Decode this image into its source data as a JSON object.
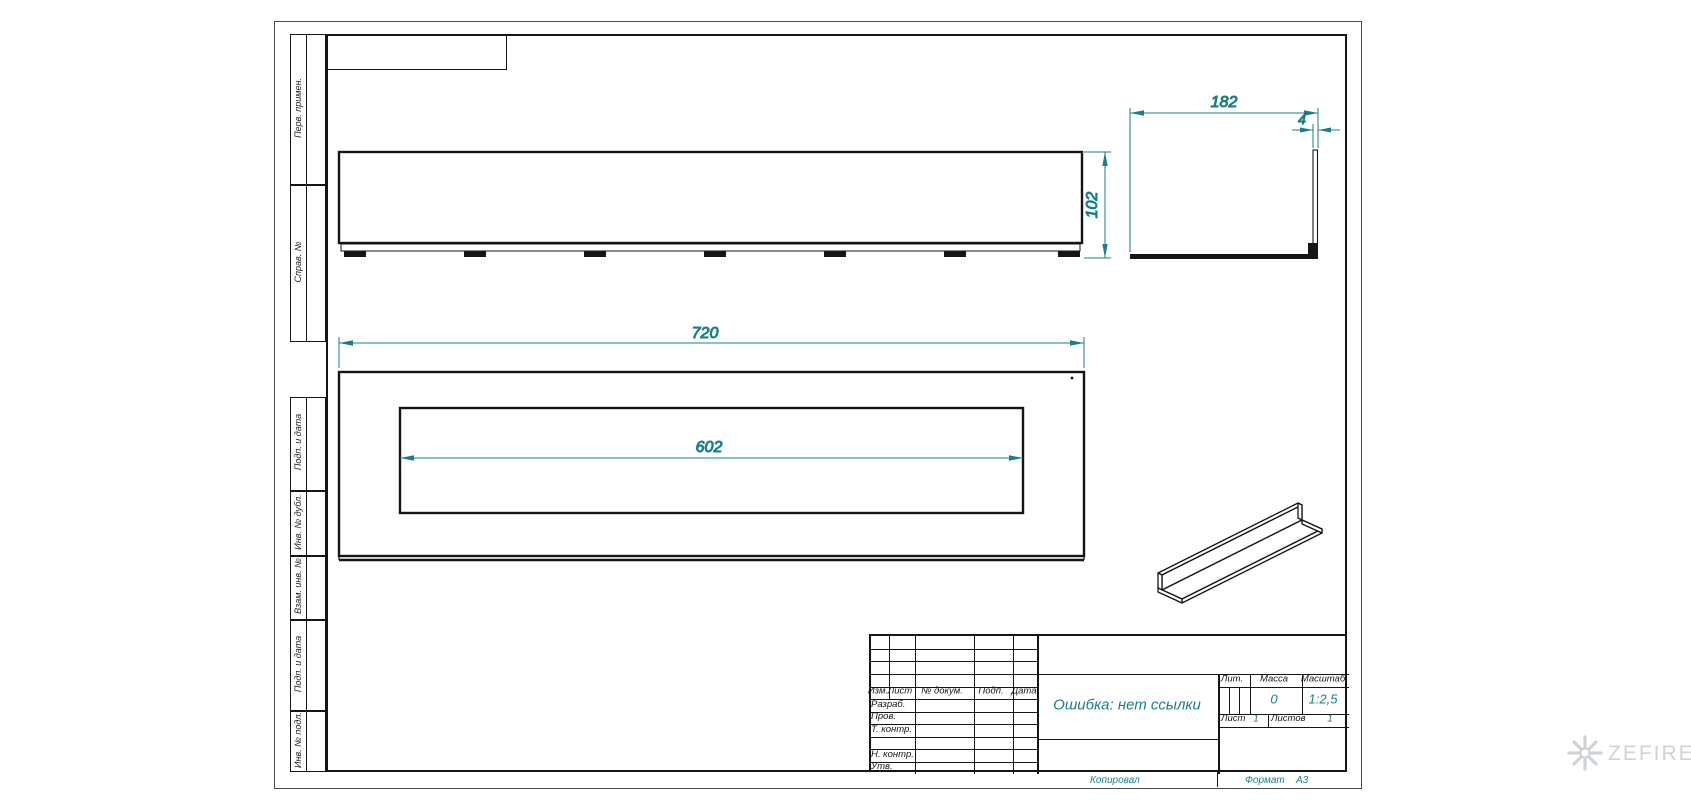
{
  "dims": {
    "length": "720",
    "slot": "602",
    "depth": "182",
    "height": "102",
    "thickness": "4"
  },
  "margin": {
    "boxes": [
      {
        "label": "Перв. примен."
      },
      {
        "label": "Справ. №"
      },
      {
        "label": "Подп. и дата"
      },
      {
        "label": "Инв. № дубл."
      },
      {
        "label": "Взам. инв. №"
      },
      {
        "label": "Подп. и дата"
      },
      {
        "label": "Инв. № подл."
      }
    ]
  },
  "title_block": {
    "change_header": [
      "Изм.",
      "Лист",
      "№ докум.",
      "Подп.",
      "Дата"
    ],
    "signature_rows": [
      "Разраб.",
      "Пров.",
      "Т. контр.",
      "Н. контр.",
      "Утв."
    ],
    "name_cell": "Ошибка: нет ссылки",
    "lit_label": "Лит.",
    "mass_label": "Масса",
    "scale_label": "Масштаб",
    "mass_value": "0",
    "scale_value": "1:2,5",
    "sheet_label": "Лист",
    "sheet_value": "1",
    "sheets_label": "Листов",
    "sheets_value": "1"
  },
  "footer": {
    "copied": "Копировал",
    "format_label": "Формат",
    "format_value": "А3"
  },
  "watermark": {
    "brand": "ZEFIRE"
  },
  "colors": {
    "dimension": "#1a7f85",
    "line": "#151515",
    "watermark": "#cfd3d6"
  }
}
